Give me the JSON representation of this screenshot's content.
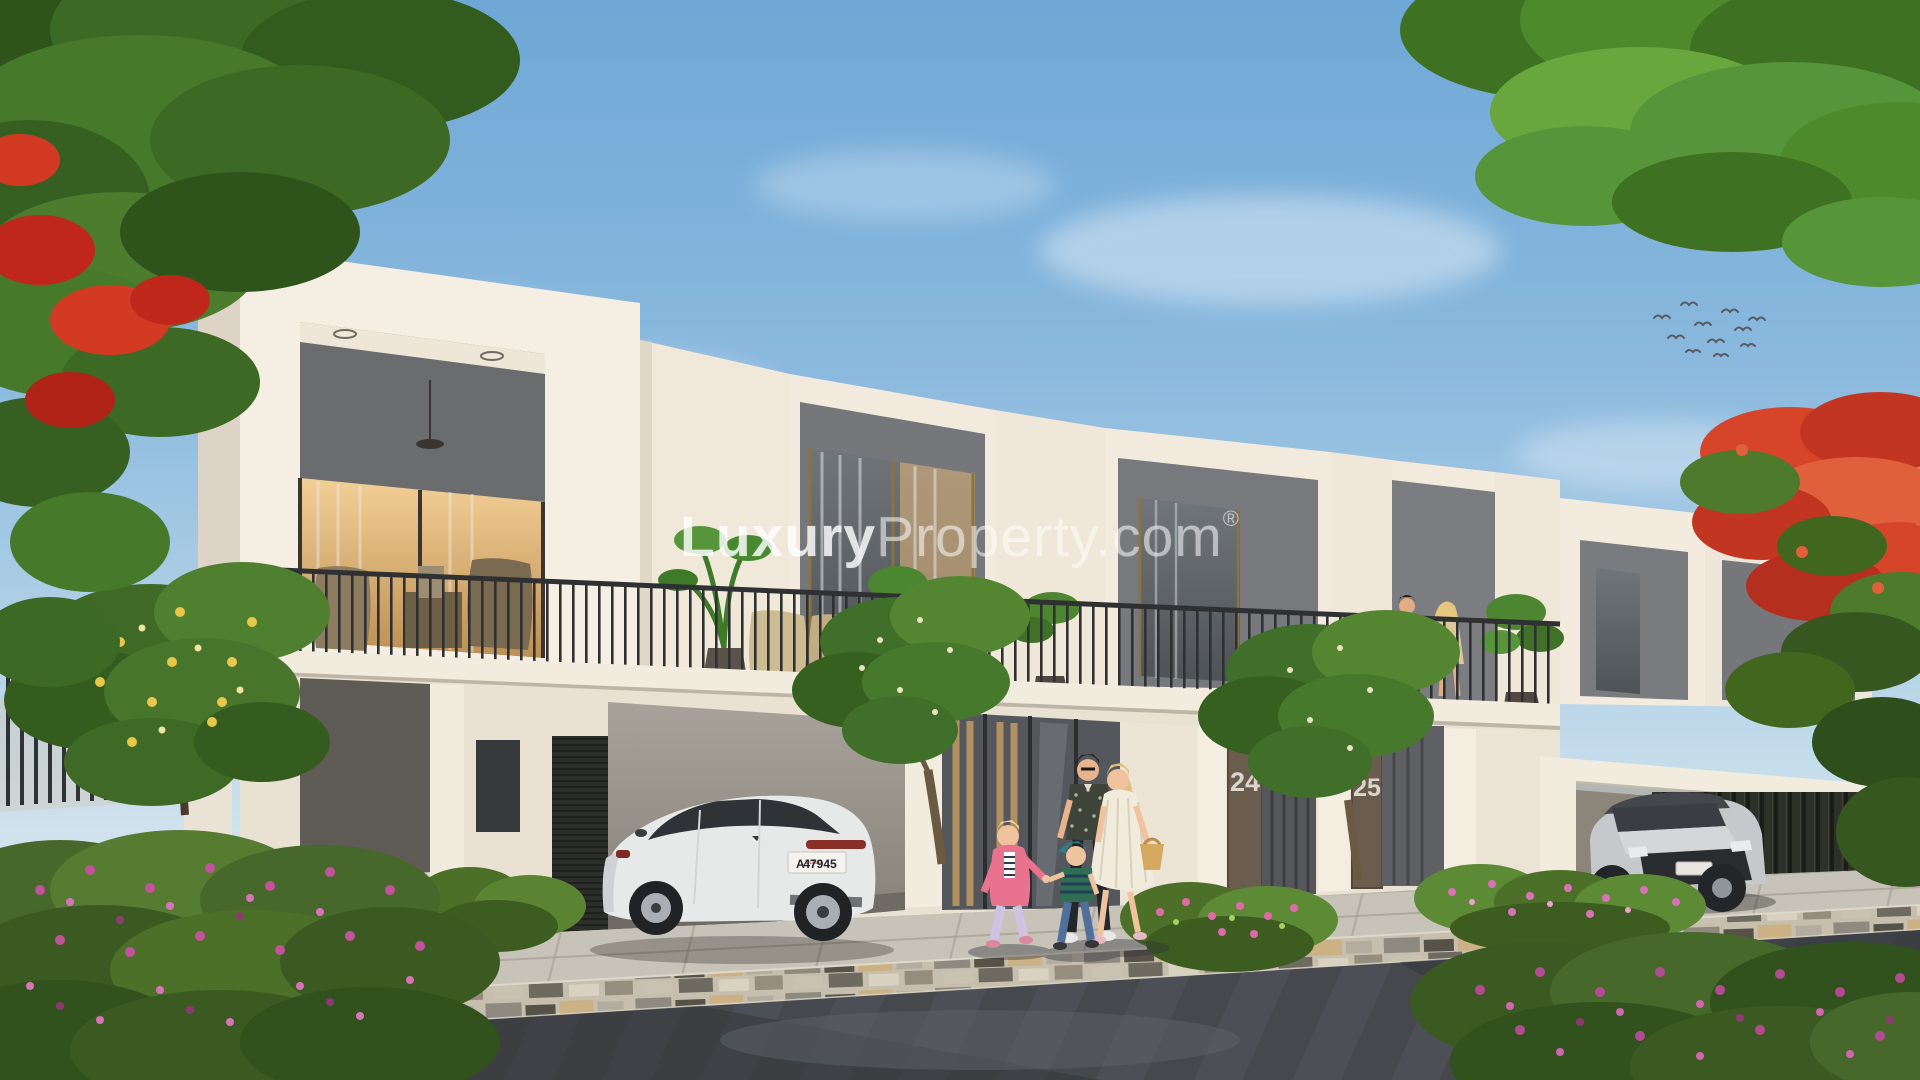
{
  "image": {
    "kind": "real-estate architectural rendering",
    "subject": "Row of modern two-storey townhouses with balconies, carports and landscaped street on a sunny day"
  },
  "watermark": {
    "bold": "Luxury",
    "light": "Property.com",
    "registered": "®"
  },
  "house_numbers": {
    "unit_left": "24",
    "unit_right": "25"
  },
  "license_plate": {
    "prefix": "A",
    "emirate": "Dubai",
    "number": "47945"
  },
  "scene_objects": {
    "vehicles": [
      "white sedan parked in carport",
      "silver SUV parked at right carport"
    ],
    "people": [
      "family of four walking on sidewalk",
      "couple standing on first-floor balcony"
    ],
    "vegetation": [
      "overhanging green canopy top-left with red blossoms",
      "overhanging green canopy top-right",
      "red flame tree at right",
      "magenta bougainvillea hedges",
      "small frangipani trees"
    ],
    "birds": "small flock in sky at upper right"
  },
  "colors": {
    "sky_top": "#6ea7d6",
    "sky_horizon": "#e2edf2",
    "facade_white": "#f2ecdf",
    "facade_shadow": "#ded6c8",
    "recess_gray": "#75777a",
    "railing_dark": "#2e3032",
    "interior_warm": "#e8b96e",
    "road_gray": "#4b4e53",
    "sidewalk": "#c3beb3",
    "hedge_green": "#5c8038",
    "flower_magenta": "#c85a9e",
    "flame_red": "#d6452a"
  }
}
